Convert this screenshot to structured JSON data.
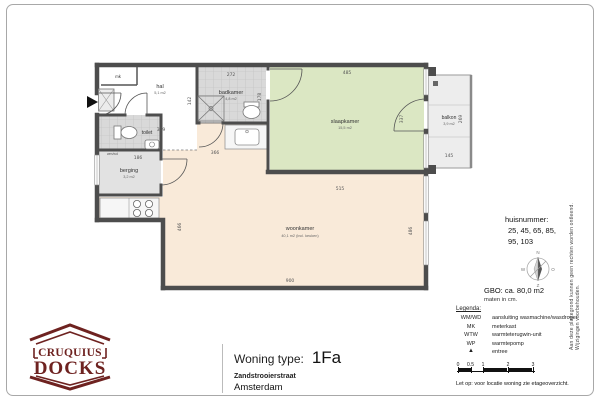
{
  "page": {
    "disclaimer": "Aan deze plattegrond kunnen geen rechten worden ontleend. Wijzigingen voorbehouden."
  },
  "title_block": {
    "label": "Woning type:",
    "value": "1Fa",
    "street": "Zandstrooierstraat",
    "city": "Amsterdam"
  },
  "logo": {
    "top": "CRUQUIUS",
    "bottom": "DOCKS"
  },
  "info_panel": {
    "huisnummer": {
      "label": "huisnummer:",
      "line1": "25, 45, 65, 85,",
      "line2": "95, 103"
    },
    "compass": {
      "north": "N",
      "east": "O",
      "south": "Z",
      "west": "W"
    },
    "gbo": "GBO: ca. 80,0 m2",
    "units_note": "maten in cm.",
    "legend": {
      "title": "Legenda:",
      "items": [
        {
          "abbr": "WM/WD",
          "desc": "aansluiting wasmachine/wasdroger"
        },
        {
          "abbr": "MK",
          "desc": "meterkast"
        },
        {
          "abbr": "WTW",
          "desc": "warmteterugwin-unit"
        },
        {
          "abbr": "WP",
          "desc": "warmtepomp"
        }
      ],
      "entree_symbol": "▲",
      "entree_label": "entree",
      "scale_ticks": [
        "0",
        "0.5",
        "1",
        "2",
        "3"
      ],
      "note": "Let op:   voor locatie woning zie etageoverzicht."
    }
  },
  "floorplan": {
    "rooms": {
      "hal": {
        "name": "hal",
        "area": "5,1 m2"
      },
      "badkamer": {
        "name": "badkamer",
        "area": "4,8 m2"
      },
      "slaapkamer": {
        "name": "slaapkamer",
        "area": "15,5 m2"
      },
      "woonkamer": {
        "name": "woonkamer",
        "area": "40,1 m2 (incl. keuken)"
      },
      "berging": {
        "name": "berging",
        "area": "3,2 m2"
      },
      "toilet": {
        "name": "toilet"
      },
      "balkon": {
        "name": "balkon",
        "area": "3,9 m2"
      },
      "mk": {
        "name": "mk"
      },
      "wmwd": {
        "name": "wm/wd"
      }
    },
    "dims": {
      "hal_w": "309",
      "hal_h": "142",
      "badkamer_w": "272",
      "badkamer_h": "178",
      "slaapkamer_w": "485",
      "slaapkamer_h": "337",
      "balkon_w": "145",
      "balkon_h": "269",
      "berging_w": "186",
      "kitchen_w": "366",
      "woonkamer_mid_w": "515",
      "woonkamer_w": "900",
      "woonkamer_left_h": "466",
      "woonkamer_right_h": "486"
    },
    "colors": {
      "wall": "#4d4d4d",
      "woonkamer_fill": "#f9ead9",
      "slaapkamer_fill": "#dbe7c3",
      "tile_fill": "#d9d9d9",
      "logo": "#6e2220"
    }
  }
}
